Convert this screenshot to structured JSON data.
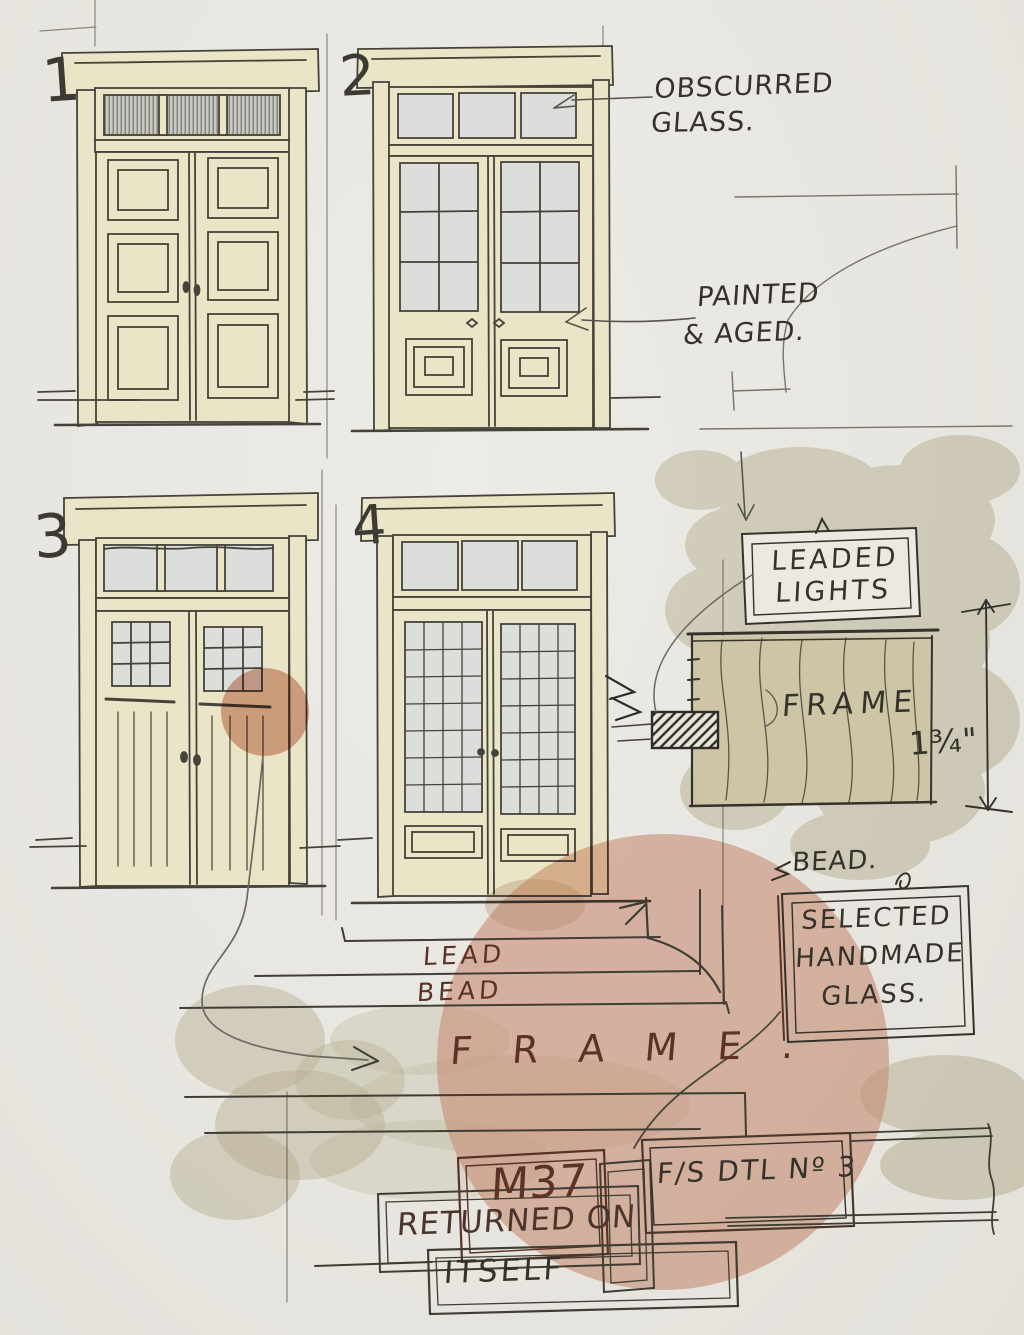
{
  "doors": [
    {
      "number": "1",
      "style": "double door, raised panels, obscured-glass transom"
    },
    {
      "number": "2",
      "style": "half-glazed double door, six panes per leaf"
    },
    {
      "number": "3",
      "style": "plank double door, small leaded windows"
    },
    {
      "number": "4",
      "style": "fully glazed leaded double door"
    }
  ],
  "labels": {
    "obscured_glass": [
      "OBSCURRED",
      "GLASS."
    ],
    "painted_aged": [
      "PAINTED",
      "& AGED."
    ],
    "leaded_lights": [
      "LEADED",
      "LIGHTS"
    ],
    "frame_block": "FRAME",
    "frame_thickness": "1¾\"",
    "bead_top": "BEAD.",
    "selected_glass": [
      "SELECTED",
      "HANDMADE",
      "GLASS."
    ],
    "lead_bead": [
      "LEAD",
      "BEAD"
    ],
    "frame_section": "F R A M E .",
    "m37": "M37",
    "returned_on": "RETURNED ON",
    "itself": "ITSELF",
    "fs_detail": "F/S DTL Nº 3"
  },
  "colors": {
    "paper": "#e8e6e0",
    "door_cream": "#e9e5c6",
    "glass": "#dbdeda",
    "wash_tan": "#c9c2a4",
    "wash_salmon": "#db9e88",
    "ink": "#34322a",
    "ink_brown": "#5a3226",
    "pencil": "#8a877c"
  }
}
